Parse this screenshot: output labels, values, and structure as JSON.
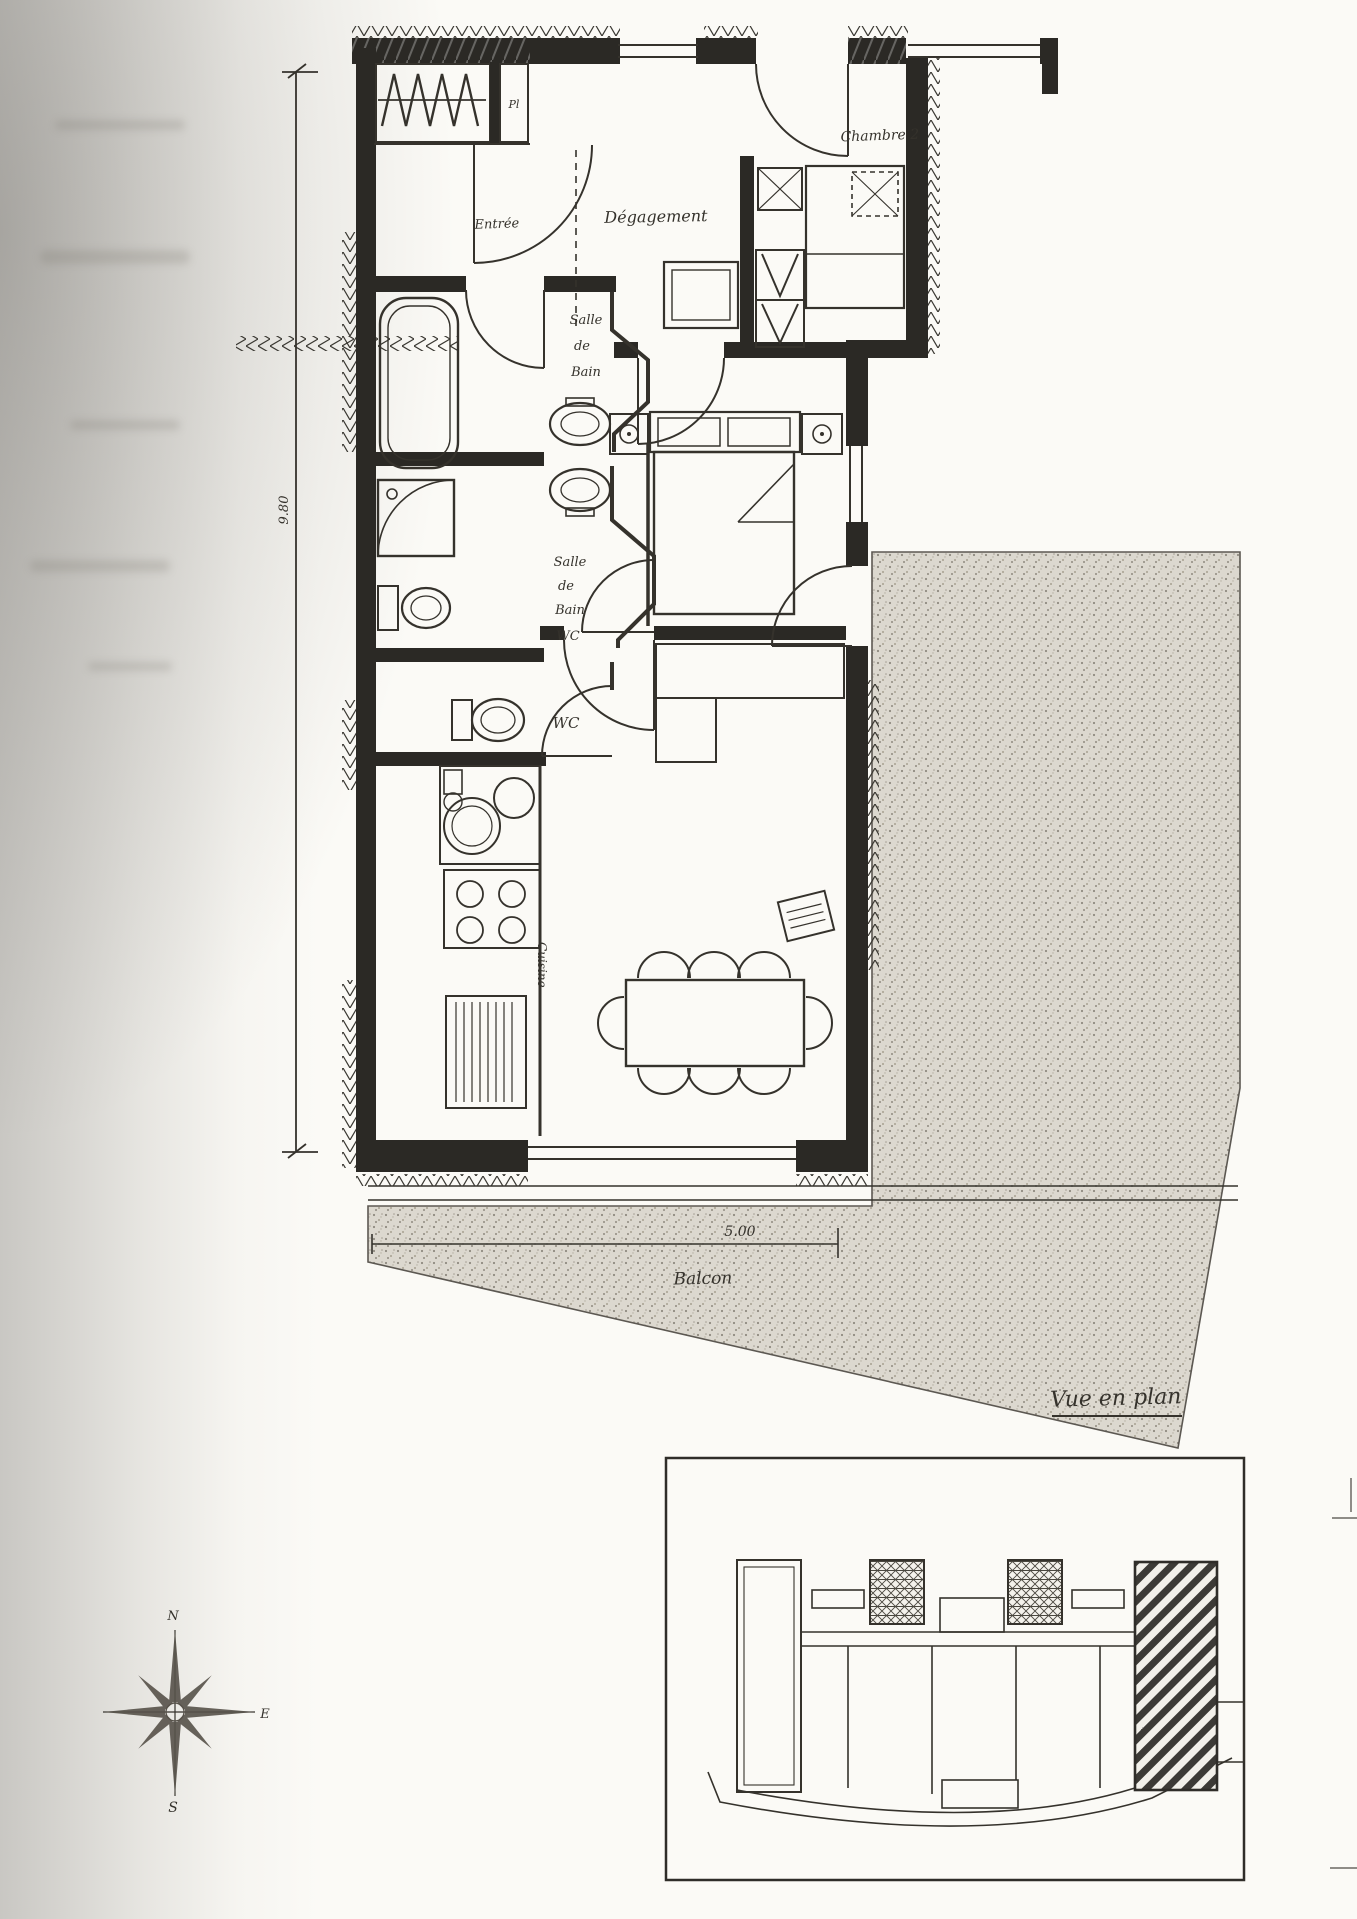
{
  "plan": {
    "labels": {
      "entry": "Entrée",
      "hallway": "Dégagement",
      "bedroom2": "Chambre 2",
      "closet_cell": "Pl",
      "bath1": [
        "Salle",
        "de",
        "Bain"
      ],
      "bath2": [
        "Salle",
        "de",
        "Bain",
        "WC"
      ],
      "wc": "WC",
      "kitchen": "Cuisine",
      "balcony": "Balcon"
    },
    "dimensions": {
      "vertical": "9.80",
      "balcony": "5.00"
    },
    "caption": "Vue en plan"
  },
  "compass": {
    "n": "N",
    "e": "E",
    "s": "S"
  },
  "colors": {
    "ink": "#2b2925",
    "paper": "#fbfaf6",
    "terrace_fill": "#dcd8cf"
  }
}
